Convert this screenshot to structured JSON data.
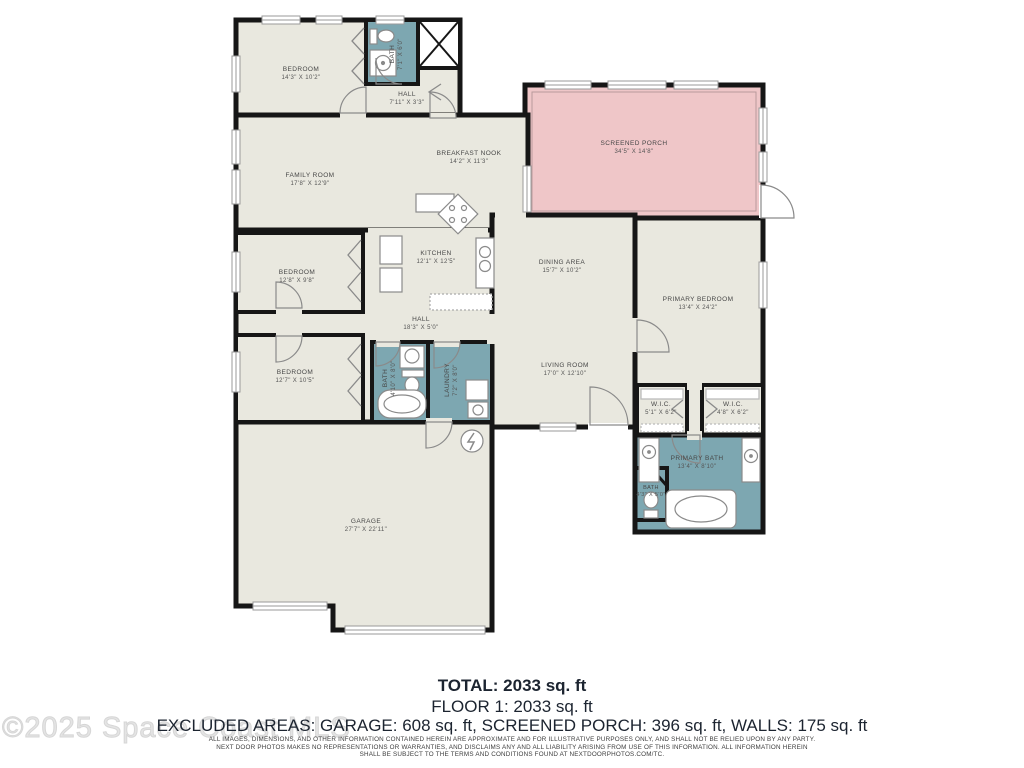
{
  "watermark": "©2025 Space Coast MLS",
  "colors": {
    "floor": "#e9e8df",
    "wet_area": "#7da7b1",
    "screened_porch": "#efc6c8",
    "wall": "#161616"
  },
  "rooms": [
    {
      "name": "BEDROOM",
      "dims": "14'3\" X 10'2\""
    },
    {
      "name": "BATH",
      "dims": "7'1\" X 6'0\""
    },
    {
      "name": "HALL",
      "dims": "7'11\" X 3'3\""
    },
    {
      "name": "FAMILY ROOM",
      "dims": "17'8\" X 12'9\""
    },
    {
      "name": "BREAKFAST NOOK",
      "dims": "14'2\" X 11'3\""
    },
    {
      "name": "SCREENED PORCH",
      "dims": "34'5\" X 14'8\""
    },
    {
      "name": "KITCHEN",
      "dims": "12'1\" X 12'5\""
    },
    {
      "name": "BEDROOM",
      "dims": "12'8\" X 9'8\""
    },
    {
      "name": "HALL",
      "dims": "18'3\" X 5'0\""
    },
    {
      "name": "DINING AREA",
      "dims": "15'7\" X 10'2\""
    },
    {
      "name": "PRIMARY BEDROOM",
      "dims": "13'4\" X 24'2\""
    },
    {
      "name": "BEDROOM",
      "dims": "12'7\" X 10'5\""
    },
    {
      "name": "BATH",
      "dims": "4'10\" X 8'0\""
    },
    {
      "name": "LAUNDRY",
      "dims": "7'2\" X 8'0\""
    },
    {
      "name": "LIVING ROOM",
      "dims": "17'0\" X 12'10\""
    },
    {
      "name": "W.I.C.",
      "dims": "5'1\" X 6'2\""
    },
    {
      "name": "W.I.C.",
      "dims": "4'8\" X 6'2\""
    },
    {
      "name": "PRIMARY BATH",
      "dims": "13'4\" X 8'10\""
    },
    {
      "name": "BATH",
      "dims": "4'3\" X 5'0\""
    },
    {
      "name": "GARAGE",
      "dims": "27'7\" X 22'11\""
    }
  ],
  "summary": {
    "total": "TOTAL: 2033 sq. ft",
    "floor1": "FLOOR 1: 2033 sq. ft",
    "excluded": "EXCLUDED AREAS: GARAGE: 608 sq. ft, SCREENED PORCH: 396 sq. ft, WALLS: 175 sq. ft"
  },
  "disclaimer": [
    "ALL IMAGES, DIMENSIONS, AND OTHER INFORMATION CONTAINED HEREIN ARE APPROXIMATE AND FOR ILLUSTRATIVE PURPOSES ONLY, AND SHALL NOT BE RELIED UPON BY ANY PARTY.",
    "NEXT DOOR PHOTOS MAKES NO REPRESENTATIONS OR WARRANTIES, AND DISCLAIMS ANY AND ALL LIABILITY ARISING FROM USE OF THIS INFORMATION. ALL INFORMATION HEREIN",
    "SHALL BE SUBJECT TO THE TERMS AND CONDITIONS FOUND AT NEXTDOORPHOTOS.COM/TC."
  ]
}
